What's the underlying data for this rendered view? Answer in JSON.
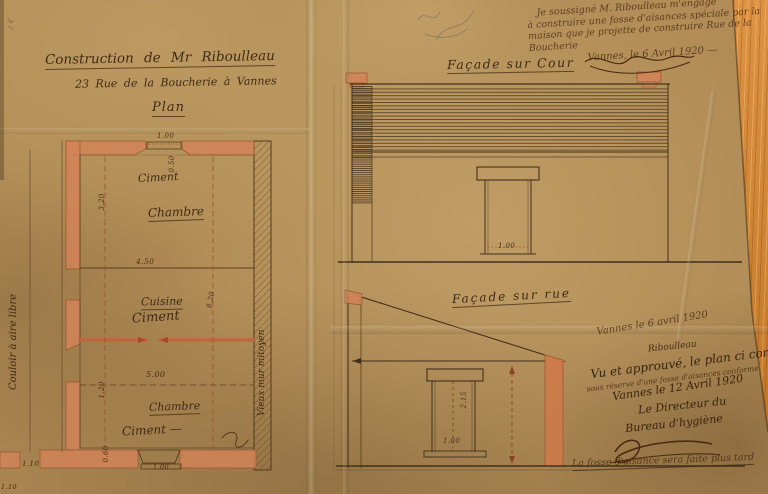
{
  "colors": {
    "paper": "#b18c56",
    "wall_fill": "#d28358",
    "ink": "#3f2a14",
    "wood": "#cc8232",
    "red_dashed": "#a8452a"
  },
  "title_block": {
    "line1": "Construction de Mr Riboulleau",
    "line2": "23 Rue de la Boucherie à Vannes",
    "line3": "Plan"
  },
  "engagement_note": {
    "line1": "Je soussigné M. Riboulleau m'engage",
    "line2": "à construire une fosse d'aisances spéciale par la",
    "line3": "maison que je projette de construire Rue de la",
    "line4": "Boucherie",
    "date_line": "Vannes, le 6 Avril 1920 —"
  },
  "facade_cour": {
    "label": "Façade sur Cour",
    "door_width": "1.00"
  },
  "facade_rue": {
    "label": "Façade sur rue",
    "door_width": "1.00",
    "door_height": "2.15"
  },
  "plan": {
    "label_couloir": "Couloir à aire libre",
    "label_mur_mitoyen": "Vieux mur mitoyen",
    "rooms": {
      "top_finish": "Ciment",
      "top_name": "Chambre",
      "mid_name": "Cuisine",
      "mid_finish": "Ciment",
      "bottom_name": "Chambre",
      "bottom_finish": "Ciment —"
    },
    "dimensions": {
      "top_door": "1.00",
      "v050a": "0.50",
      "v320": "3.20",
      "h450": "4.50",
      "v820": "8.20",
      "h500": "5.00",
      "v120": "1.20",
      "v060": "0.60",
      "bottom_door": "1.00",
      "h110": "1.10",
      "corner": "1.10"
    }
  },
  "approval_block": {
    "date1": "Vannes le 6 avril 1920",
    "sig1": "Riboulleau",
    "line1": "Vu et approuvé, le plan ci contre",
    "line2": "sous réserve d'une fosse d'aisances conforme",
    "date2": "Vannes le 12 Avril 1920",
    "line3": "Le Directeur du",
    "line4": "Bureau d'hygiène"
  },
  "footer_note": "La fosse d'aisance sera faite plus tard"
}
